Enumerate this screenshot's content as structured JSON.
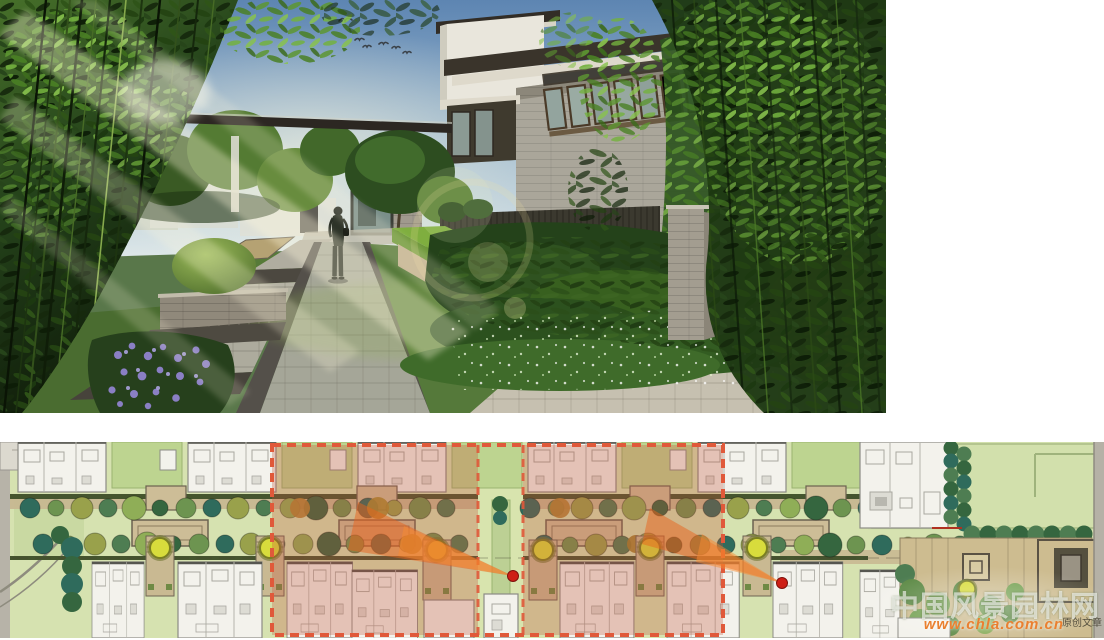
{
  "board": {
    "background": "#ffffff"
  },
  "render_view": {
    "colors": {
      "sky_top": "#5d85b2",
      "sky_horizon": "#e9efee",
      "foliage_dark": "#15250f",
      "foliage_mid": "#3c5c24",
      "lawn": "#55793a",
      "paving_light": "#b5b2a4",
      "paving_dark": "#4c4840",
      "stone_wall": "#a8a49a",
      "roof": "#3a342b",
      "window_frame": "#4a3a28",
      "flower_purple": "#8a7fc4"
    }
  },
  "plan_view": {
    "colors": {
      "base_green": "#d6e2b0",
      "yard_green": "#bdd490",
      "building_fill": "#f3f2ec",
      "building_line": "#8c8c86",
      "hedge_dark": "#45552e",
      "path_tan": "#c9b992",
      "tree_teal": "#2f6b5c",
      "tree_green": "#6d9450",
      "tree_olive": "#99a14b",
      "tree_accent_yellow": "#d8dc3c",
      "plaza_deck": "#cdbc90",
      "road_gray": "#b5b1a6"
    },
    "highlight": {
      "dashed_border": "#e0593a",
      "overlay_fill": "rgba(197,82,55,0.30)",
      "cone_fill": "rgba(232,100,28,0.50)",
      "cone_inner_fill": "rgba(248,140,50,0.50)",
      "dot_color": "#ce1f16"
    }
  },
  "watermark": {
    "site_name": "中国风景园林网",
    "url": "www.chla.com.cn",
    "suffix": "原创文章",
    "url_color": "#ea8030"
  }
}
